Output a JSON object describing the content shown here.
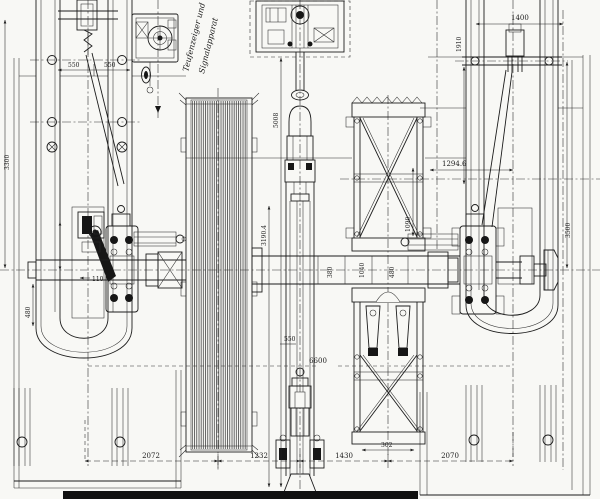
{
  "annotation": {
    "line1": "Teufenzeiger und",
    "line2": "Signalapparat"
  },
  "dimensions": {
    "top_left_a": "550",
    "top_left_b": "550",
    "top_right": "1400",
    "right_upper": "1910",
    "right_edge": "3500",
    "left_edge": "3300",
    "piston_upper": "5008",
    "piston_lower": "3190.4",
    "crank_right": "1294.6",
    "girder_height": "1090",
    "girder_width": "302",
    "shaft_a": "380",
    "shaft_b": "1040",
    "shaft_c": "480",
    "center_span": "6600",
    "rod_guide": "550",
    "bearing_left": "110",
    "left_lower": "480",
    "bottom_a": "2072",
    "bottom_b": "1232",
    "bottom_c": "1430",
    "bottom_d": "2070"
  }
}
